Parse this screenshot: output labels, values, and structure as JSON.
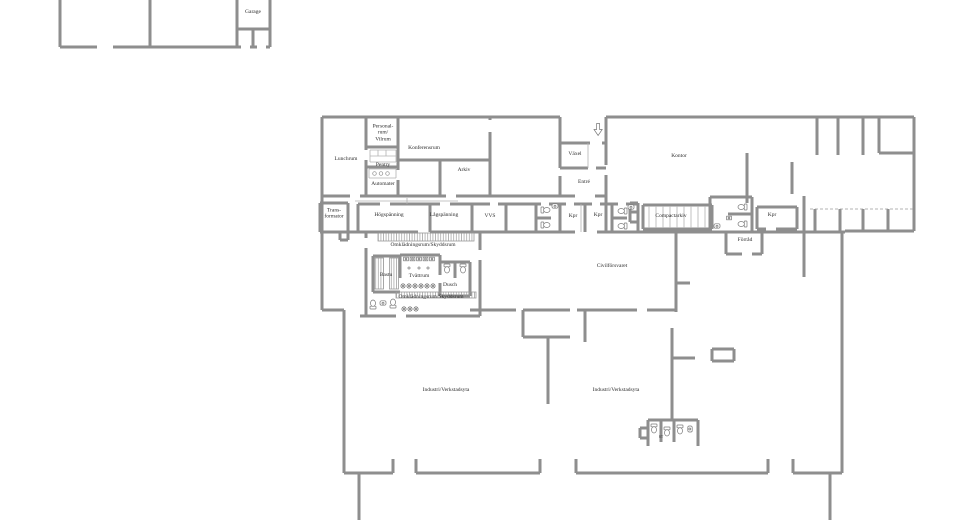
{
  "colors": {
    "wall": "#8e8e8e",
    "text": "#2e2e2e",
    "background": "#ffffff"
  },
  "outbuilding": {
    "garage": "Garage"
  },
  "rooms": {
    "lunchrum": "Lunchrum",
    "personalrum": "Personal-\nrum/\nVilrum",
    "pentry": "Pentry",
    "automater": "Automater",
    "konferensrum": "Konferensrum",
    "arkiv": "Arkiv",
    "vaxel": "Växel",
    "entre": "Entré",
    "kontor": "Kontor",
    "transformator": "Trans-\nformator",
    "hogspanning": "Högspänning",
    "lagspanning": "Lågspänning",
    "vvs": "VVS",
    "kpr_a": "Kpr",
    "kpr_b": "Kpr",
    "compactarkiv": "Compactarkiv",
    "kpr_c": "Kpr",
    "forrad": "Förråd",
    "omkladningsrum_norr": "Omklädningsrum/Skyddsrum",
    "bastu": "Bastu",
    "tvattrum": "Tvättrum",
    "dusch": "Dusch",
    "omkladningsrum_soder": "Omklädningsrum/Skyddsrum",
    "civilforsvaret": "Civilförsvaret",
    "industri_vast": "Industri/Verkstadsyta",
    "industri_ost": "Industri/Verkstadsyta",
    "stad": "ST"
  }
}
